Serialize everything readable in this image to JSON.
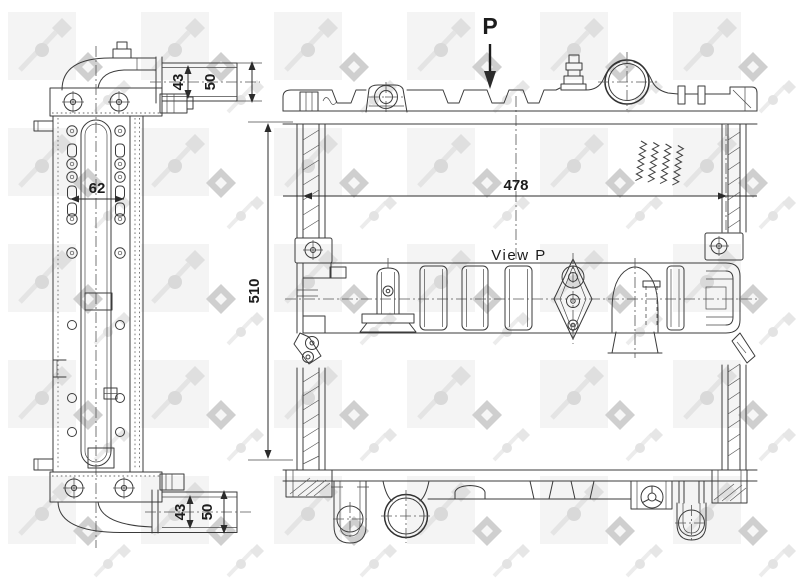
{
  "drawing": {
    "type": "technical-drawing",
    "subject": "radiator",
    "brand_watermark": "NRF",
    "labels": {
      "direction": "P",
      "view": "View P"
    },
    "dimensions": {
      "front_width": "478",
      "front_height": "510",
      "hole_spacing": "62",
      "top_pipe_inner": "43",
      "top_pipe_outer": "50",
      "bottom_pipe_inner": "43",
      "bottom_pipe_outer": "50"
    },
    "colors": {
      "line": "#3b3b3b",
      "background": "#ffffff",
      "watermark_light": "#f4f4f4",
      "watermark_mid": "#dcdcdc",
      "watermark_dark": "#cfcfcf"
    }
  }
}
